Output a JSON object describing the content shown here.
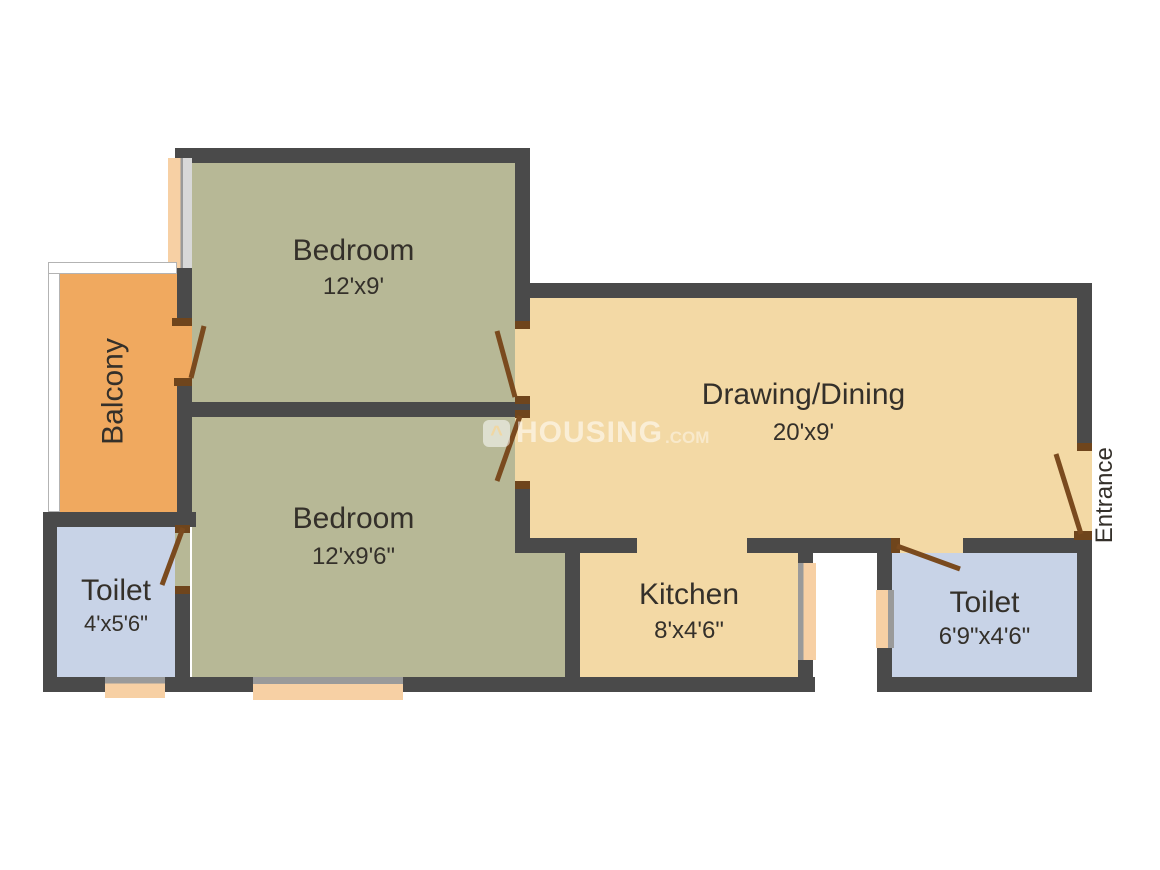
{
  "plan": {
    "type": "floor-plan",
    "rooms": {
      "bedroom1": {
        "name": "Bedroom",
        "dims": "12'x9'"
      },
      "bedroom2": {
        "name": "Bedroom",
        "dims": "12'x9'6\""
      },
      "drawing": {
        "name": "Drawing/Dining",
        "dims": "20'x9'"
      },
      "kitchen": {
        "name": "Kitchen",
        "dims": "8'x4'6\""
      },
      "toilet1": {
        "name": "Toilet",
        "dims": "4'x5'6\""
      },
      "toilet2": {
        "name": "Toilet",
        "dims": "6'9\"x4'6\""
      },
      "balcony": {
        "name": "Balcony"
      },
      "entrance": {
        "label": "Entrance"
      }
    },
    "colors": {
      "wall": "#4a4a4a",
      "bedroom_floor": "#b7b896",
      "living_floor": "#f3d9a5",
      "balcony_floor": "#f0a95f",
      "toilet_floor": "#c8d3e7",
      "door_leaf": "#7a4a1e",
      "window": "#f7d0a4",
      "text": "#34302a",
      "background": "#ffffff"
    }
  },
  "watermark": {
    "brand": "HOUSING",
    "tld": ".COM",
    "icon": "housing-logo-icon"
  }
}
